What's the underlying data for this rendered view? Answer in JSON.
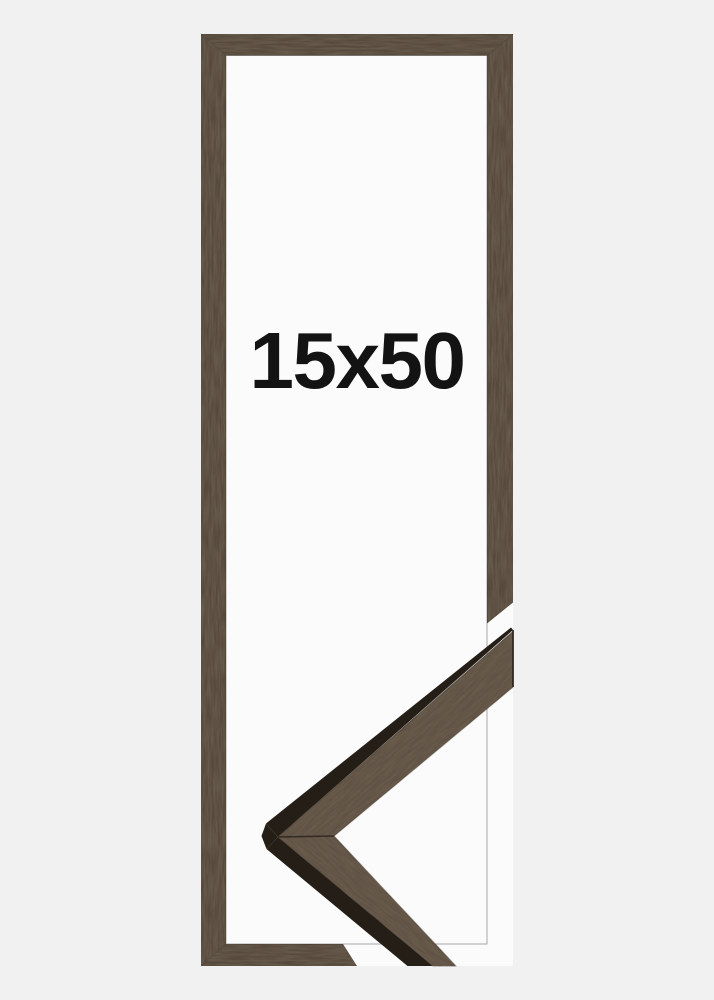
{
  "product": {
    "size_label": "15x50"
  },
  "colors": {
    "background": "#f1f1f1",
    "inner_area": "#fbfbfb",
    "frame_wood": "#574a3c",
    "detail_wood": "#5f5244",
    "wood_side": "#241e17",
    "label_text": "#131313"
  }
}
